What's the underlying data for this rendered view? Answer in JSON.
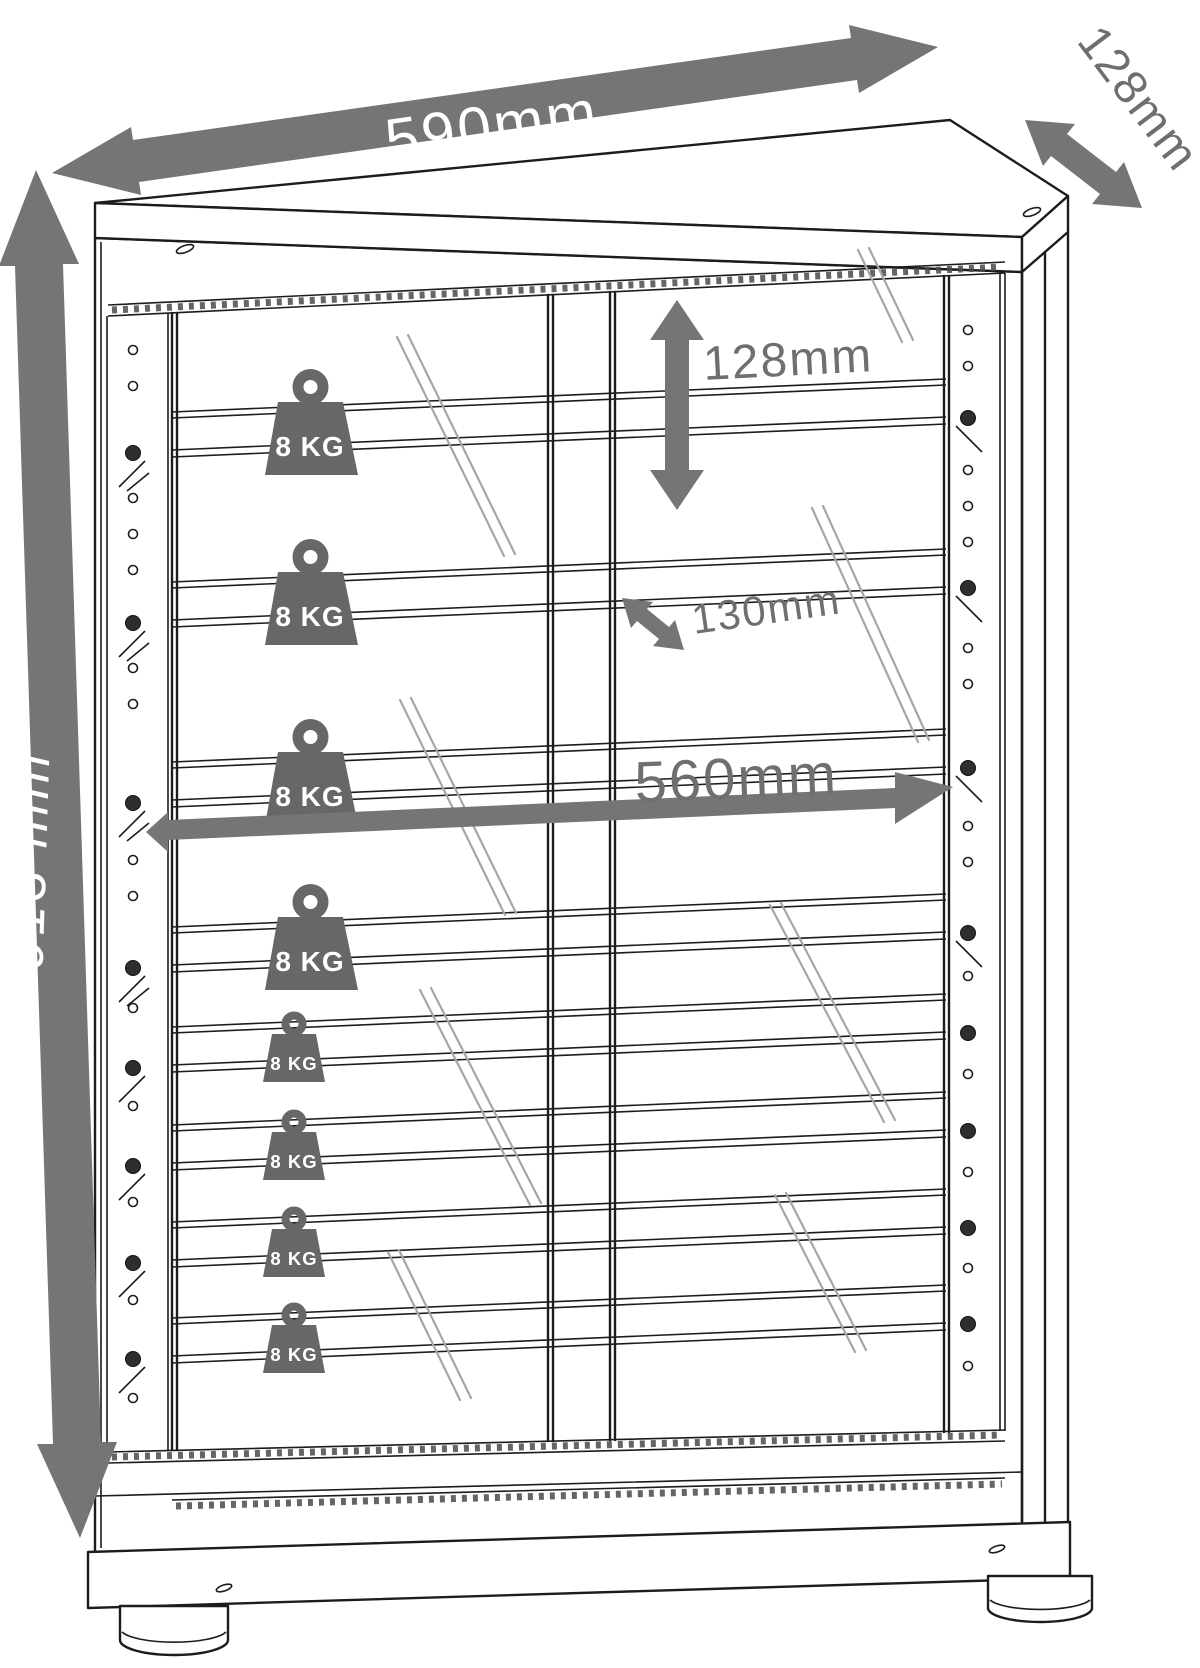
{
  "colors": {
    "background": "#ffffff",
    "ink": "#1c1c1c",
    "dimension_gray": "#6f6f6f",
    "band_gray": "#757575",
    "weight_gray": "#676767",
    "reflection_gray": "#a6a6a6",
    "label_on_band": "#ffffff"
  },
  "dimensions": {
    "overall_width": {
      "label": "590mm"
    },
    "overall_depth": {
      "label": "128mm"
    },
    "overall_height": {
      "label": "913 mm"
    },
    "shelf_spacing": {
      "label": "128mm"
    },
    "shelf_depth": {
      "label": "130mm"
    },
    "interior_width": {
      "label": "560mm"
    }
  },
  "weights": {
    "items": [
      {
        "label": "8 KG"
      },
      {
        "label": "8 KG"
      },
      {
        "label": "8 KG"
      },
      {
        "label": "8 KG"
      },
      {
        "label": "8 KG"
      },
      {
        "label": "8 KG"
      },
      {
        "label": "8 KG"
      },
      {
        "label": "8 KG"
      }
    ]
  }
}
